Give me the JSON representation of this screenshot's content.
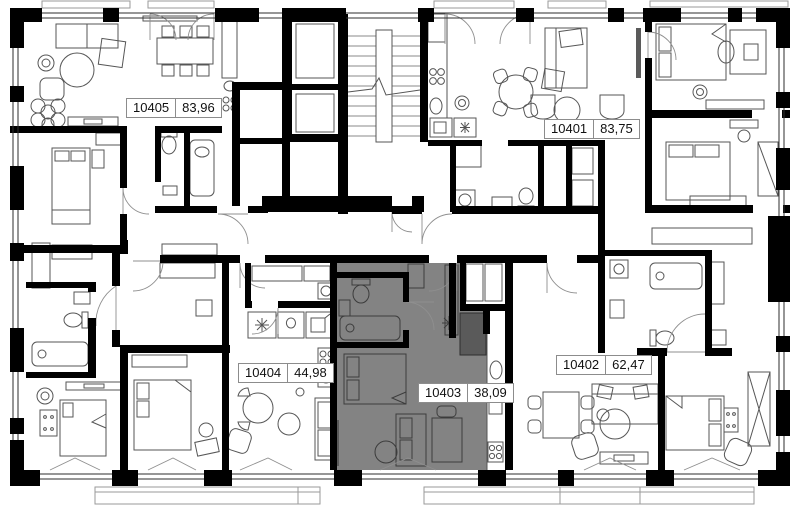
{
  "plan": {
    "title": "Residential floor plan",
    "background_color": "#ffffff",
    "wall_color": "#000000",
    "highlight_color": "#838383",
    "highlighted_unit": "10403",
    "units": [
      {
        "number": "10405",
        "area": "83,96",
        "highlighted": false
      },
      {
        "number": "10401",
        "area": "83,75",
        "highlighted": false
      },
      {
        "number": "10404",
        "area": "44,98",
        "highlighted": false
      },
      {
        "number": "10403",
        "area": "38,09",
        "highlighted": true
      },
      {
        "number": "10402",
        "area": "62,47",
        "highlighted": false
      }
    ]
  }
}
